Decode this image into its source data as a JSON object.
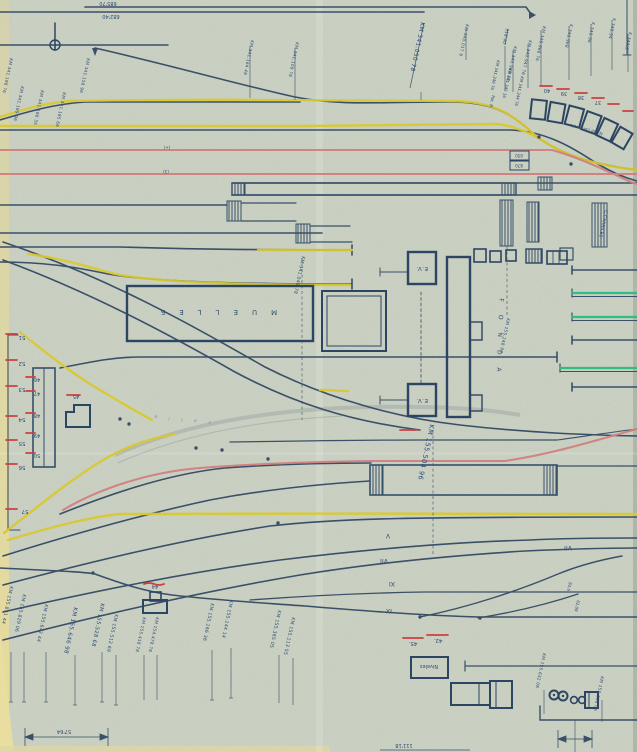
{
  "document": {
    "type": "railway-yard-track-plan",
    "description": "Scanned hand-drawn station track layout with colored route highlights"
  },
  "colors": {
    "paper": "#cfd5c6",
    "paper_edge": "#e6db9d",
    "ink": "#3a5068",
    "ink_text": "#2c4b74",
    "route_yellow": "#d9c92f",
    "route_pink": "#d08080",
    "mark_red": "#cc4040",
    "route_green": "#2ebd84"
  },
  "elevations": {
    "upper": "685'70",
    "lower": "682'40"
  },
  "annotations": {
    "plus": "(+)",
    "three": "(3)",
    "comercio": "N. de comercio",
    "calle": "c a l l e",
    "c_carriles": "C.CARRILES",
    "v816": "81,6",
    "v6208": "62,08"
  },
  "buildings": {
    "muelles": "MUELLES",
    "fonda": "FONDA",
    "ev_north": "E.V.",
    "ev_south": "E.V.",
    "niveles": "Niveles",
    "shed_44": "44",
    "shed_45": "45"
  },
  "box_values": {
    "top": "650",
    "bottom": "870"
  },
  "track_numbers": {
    "curve_row": [
      "40",
      "39",
      "38",
      "37"
    ],
    "ladder_outer": [
      "51",
      "52",
      "53",
      "54",
      "55",
      "56",
      "57"
    ],
    "ladder_inner": [
      "46",
      "47",
      "48",
      "49",
      "50"
    ],
    "pair": [
      "45.",
      "42."
    ],
    "romans": [
      "V",
      "VII",
      "XI",
      "IX",
      "VII"
    ]
  },
  "km_top": [
    {
      "t": "KM 341.198 76"
    },
    {
      "t": "KM 341.189 96"
    },
    {
      "t": "KM 341.186 35"
    },
    {
      "t": "KM 341.185 66"
    },
    {
      "t": "KM 341.158 96"
    },
    {
      "t": "KM 341.164 48"
    },
    {
      "t": "KM 341.109 78"
    },
    {
      "t": "KM 341.050 78"
    },
    {
      "t": "KM 340.017 9"
    },
    {
      "t": "318'40"
    },
    {
      "t": "KM 340.968 40"
    },
    {
      "t": "KM 340.947 76"
    },
    {
      "t": "KM 340.966 76"
    },
    {
      "t": "K 340.968"
    },
    {
      "t": "K 340.96"
    },
    {
      "t": "K 340.94"
    },
    {
      "t": "K 340.9"
    },
    {
      "t": "KM 341.346 76"
    },
    {
      "t": "KM 341.345 16"
    },
    {
      "t": "KM 341.344 76"
    },
    {
      "t": "Rot. B"
    }
  ],
  "km_bottom": [
    {
      "t": "KM 155.851 44"
    },
    {
      "t": "KM 155.829 06"
    },
    {
      "t": "KM 155.642 44"
    },
    {
      "t": "KM 155.646 98"
    },
    {
      "t": "KM 155.528 68"
    },
    {
      "t": "KM 155.512 69"
    },
    {
      "t": "KM 155.418 78"
    },
    {
      "t": "KM 154.478 78"
    },
    {
      "t": "KM 155.166 36"
    },
    {
      "t": "KM 155.144 14"
    },
    {
      "t": "KM 155.365 05"
    },
    {
      "t": "KM 155.113 55"
    },
    {
      "t": "KM 155.632 08"
    },
    {
      "t": "KM 155.608 06"
    }
  ],
  "km_mid": [
    {
      "t": "KM 341.048 78"
    },
    {
      "t": "KM 155.504 96"
    },
    {
      "t": "KM 155.248 90"
    }
  ],
  "dimensions": {
    "left": "57'64",
    "bottom": "111'18"
  }
}
